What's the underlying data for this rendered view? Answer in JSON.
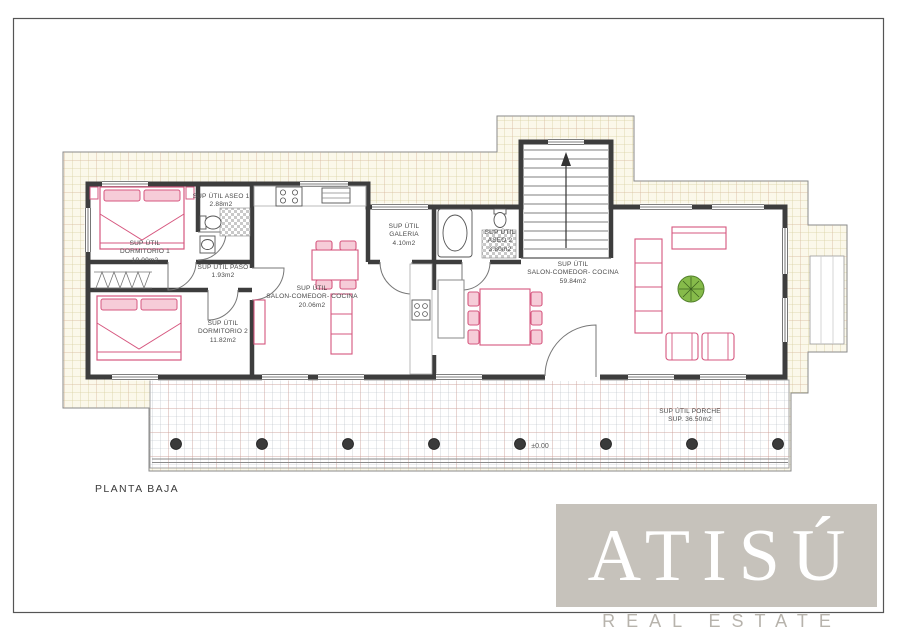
{
  "plan": {
    "title": "PLANTA BAJA",
    "level_mark": "±0.00"
  },
  "rooms": {
    "dormitorio1": {
      "line1": "SUP ÚTIL",
      "line2": "DORMITORIO 1",
      "line3": "10.00m2"
    },
    "aseo1": {
      "line1": "SUP ÚTIL ASEO 1",
      "line2": "2.88m2"
    },
    "paso": {
      "line1": "SUP ÚTIL PASO",
      "line2": "1.93m2"
    },
    "salon_comedor_small": {
      "line1": "SUP ÚTIL",
      "line2": "SALON-COMEDOR- COCINA",
      "line3": "20.06m2"
    },
    "galeria": {
      "line1": "SUP ÚTIL",
      "line2": "GALERIA",
      "line3": "4.10m2"
    },
    "aseo2": {
      "line1": "SUP ÚTIL",
      "line2": "ASEO 2",
      "line3": "3.80m2"
    },
    "salon_comedor_main": {
      "line1": "SUP ÚTIL",
      "line2": "SALON-COMEDOR- COCINA",
      "line3": "59.84m2"
    },
    "dormitorio2": {
      "line1": "SUP ÚTIL",
      "line2": "DORMITORIO 2",
      "line3": "11.82m2"
    },
    "porche": {
      "line1": "SUP ÚTIL PORCHE",
      "line2": "SUP. 36.50m2"
    }
  },
  "branding": {
    "logo": "ATISÚ",
    "tagline": "REAL ESTATE"
  },
  "colors": {
    "terrain_bg": "#fbf8ea",
    "terrain_grid": "#d8d0a2",
    "porch_grid": "#b4b9c2",
    "porch_grid_accent": "#d09a90",
    "wall": "#3d3d3d",
    "furniture_pink": "#d6577f",
    "furniture_pink_fill": "#f6ccd8",
    "plant_green": "#86bb4a",
    "logo_box": "#c6c2bb",
    "logo_text": "#ffffff",
    "tagline_text": "#b7b3ac"
  }
}
